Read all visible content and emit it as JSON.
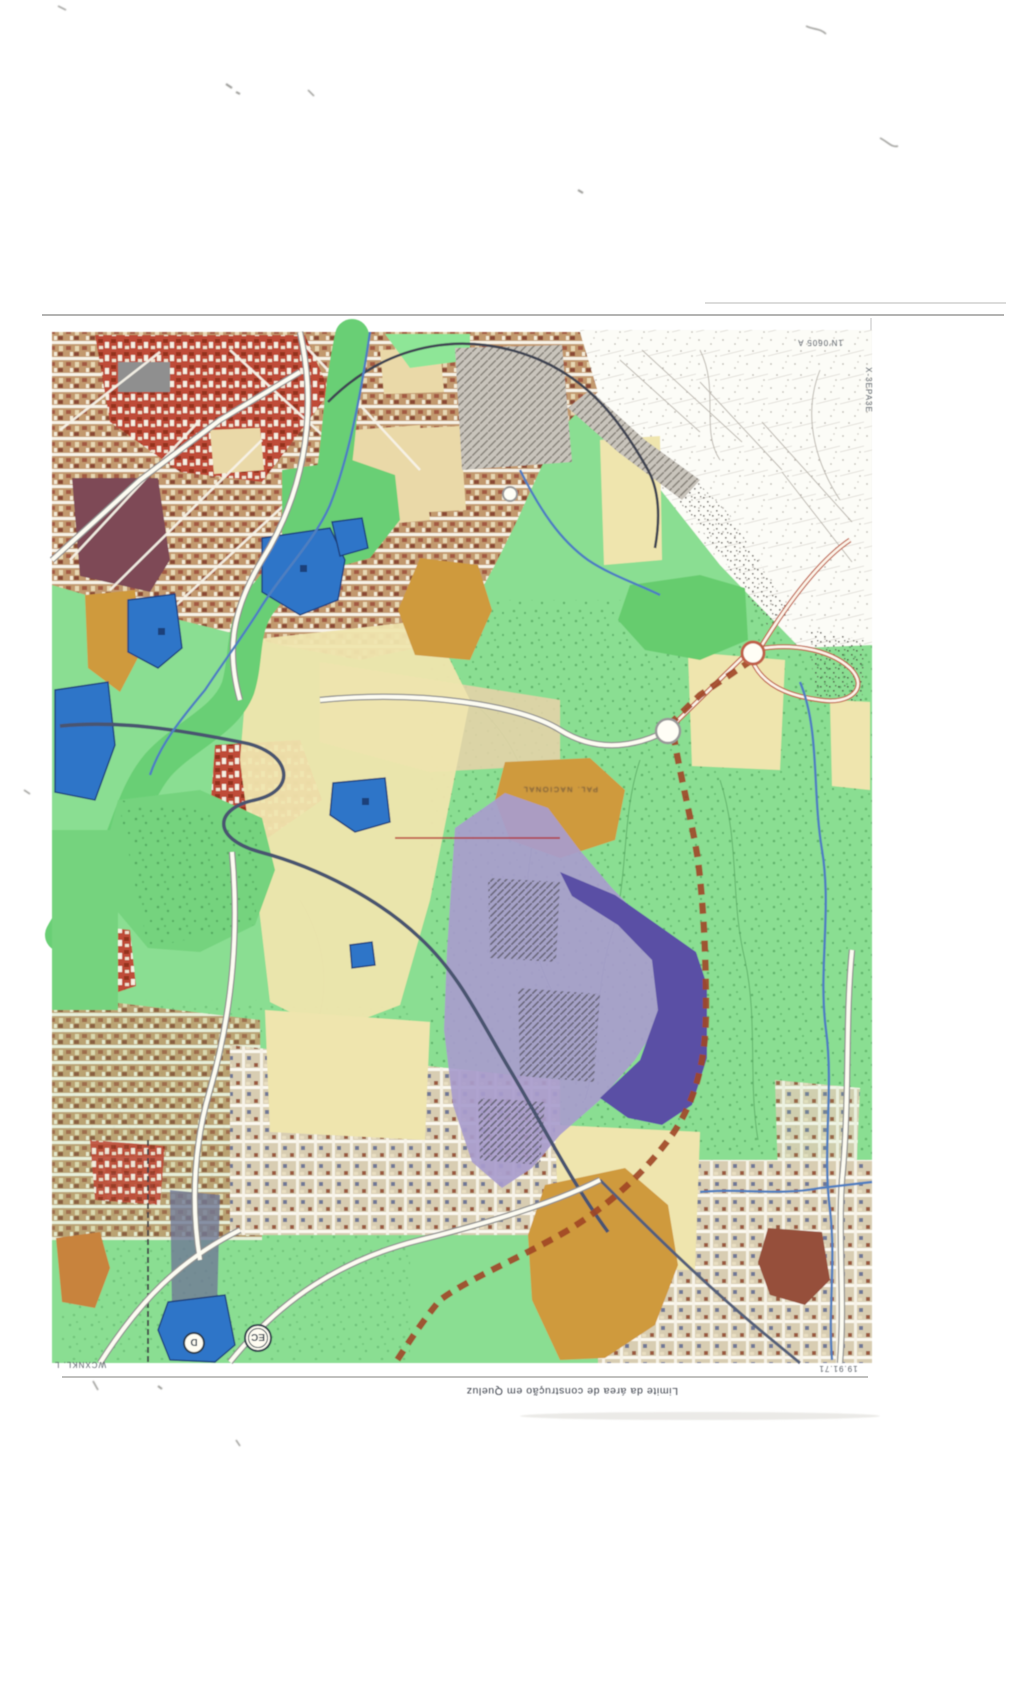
{
  "scan": {
    "corner_refs": {
      "top_right_horizontal": "1N'0605 A",
      "top_right_vertical": "X-3EPA3E",
      "bottom_left": "WCXNKL. L",
      "bottom_right": "19.91.71"
    },
    "caption_upside_down": "Limite da área de construção em Queluz",
    "map_labels": {
      "palace": "PAL. NACIONAL",
      "marker_ec": "EC",
      "marker_d": "D"
    },
    "colors": {
      "page_background": "#ffffff",
      "base_green": "#8ade92",
      "bright_green": "#69cf74",
      "pale_yellow": "#efe5ae",
      "ochre": "#cf9a3e",
      "lavender": "#a89ccd",
      "dark_purple": "#5a4fa5",
      "zone_blue": "#2f74c8",
      "urban_red": "#c14e38",
      "urban_brown": "#c9a379",
      "maroon": "#7e4a56",
      "boundary_red_dashed": "#a04526",
      "river_blue": "#4f7fc0",
      "railway_dark": "#3f4452"
    }
  }
}
